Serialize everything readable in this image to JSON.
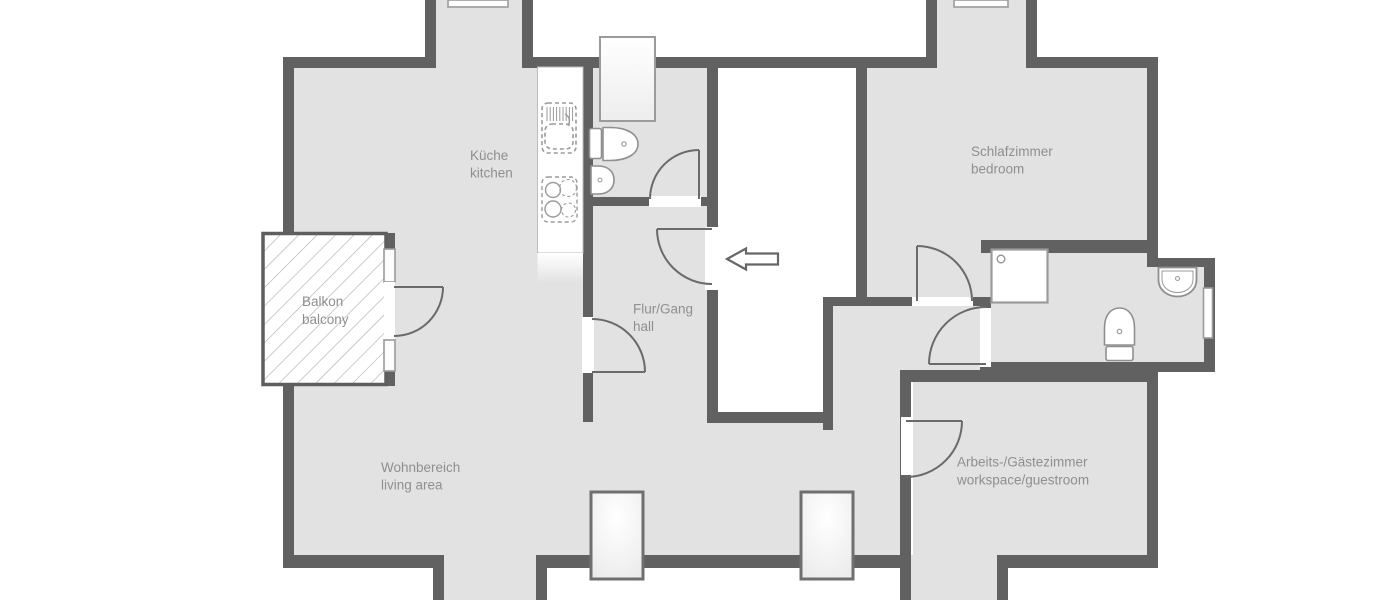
{
  "plan": {
    "type": "apartment-floor-plan",
    "rooms": [
      {
        "id": "kitchen",
        "label_de": "Küche",
        "label_en": "kitchen"
      },
      {
        "id": "balcony",
        "label_de": "Balkon",
        "label_en": "balcony"
      },
      {
        "id": "hall",
        "label_de": "Flur/Gang",
        "label_en": "hall"
      },
      {
        "id": "living",
        "label_de": "Wohnbereich",
        "label_en": "living area"
      },
      {
        "id": "bedroom",
        "label_de": "Schlafzimmer",
        "label_en": "bedroom"
      },
      {
        "id": "workspace",
        "label_de": "Arbeits-/Gästezimmer",
        "label_en": "workspace/guestroom"
      }
    ],
    "fixtures": [
      "kitchen-counter",
      "kitchen-sink",
      "stove",
      "wc-toilet",
      "wc-sink",
      "shower",
      "bathroom-toilet",
      "bathroom-sink"
    ],
    "icons": [
      "entrance-arrow-icon"
    ],
    "colors": {
      "wall": "#616161",
      "floor": "#e2e2e2",
      "outside": "#ffffff",
      "label_text": "#8f8f8f",
      "window_border": "#6f6f6f",
      "window_fill": "#f6f6f6",
      "fixture_stroke": "#8f8f8f",
      "balcony_hatch": "#b0b0b0"
    }
  }
}
